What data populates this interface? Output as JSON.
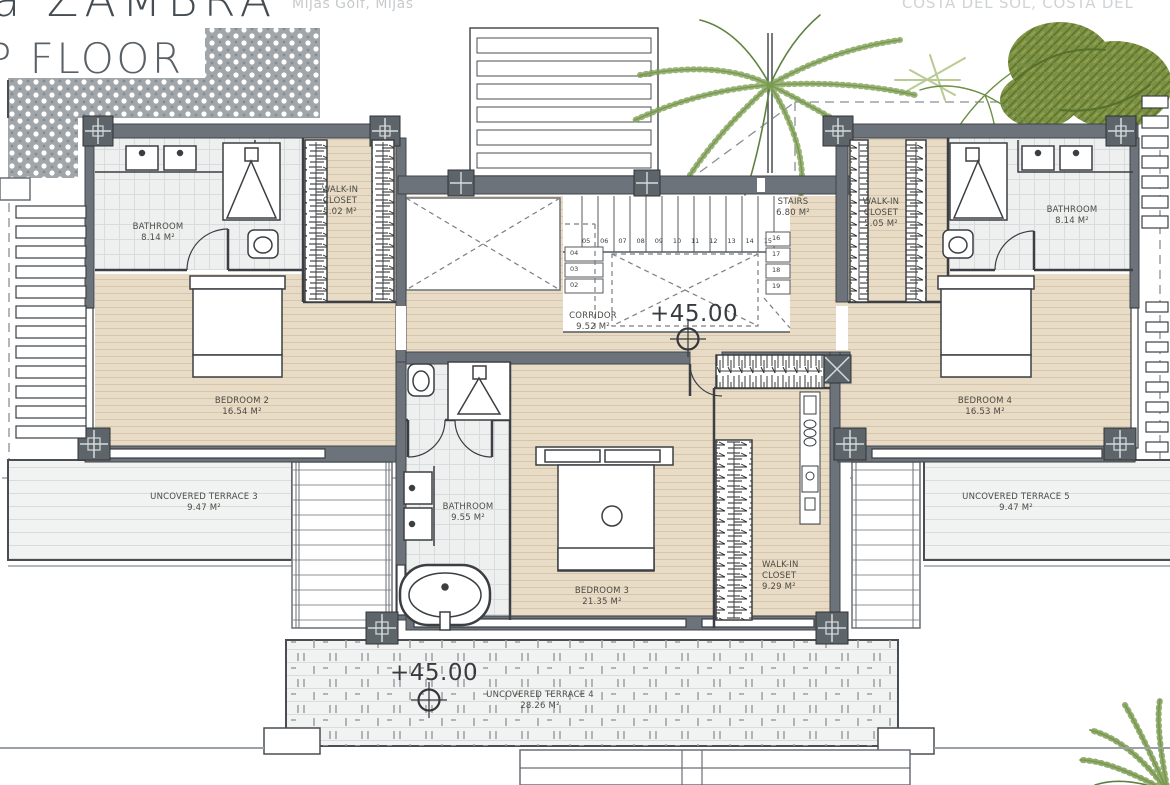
{
  "header": {
    "title_fragment": "a ZAMBRA",
    "subtitle": "Mijas Golf, Mijas",
    "location_line": "COSTA DEL SOL, COSTA DEL",
    "floor_label": "P FLOOR"
  },
  "rooms": {
    "bathroom2": {
      "name": "BATHROOM",
      "area": "8.14 M²"
    },
    "closet2": {
      "name": "WALK-IN CLOSET",
      "area": "5.02 M²"
    },
    "bedroom2": {
      "name": "BEDROOM 2",
      "area": "16.54 M²"
    },
    "stairs": {
      "name": "STAIRS",
      "area": "6.80 M²"
    },
    "corridor": {
      "name": "CORRIDOR",
      "area": "9.52 M²"
    },
    "closet4": {
      "name": "WALK-IN CLOSET",
      "area": "5.05 M²"
    },
    "bathroom4": {
      "name": "BATHROOM",
      "area": "8.14 M²"
    },
    "bedroom4": {
      "name": "BEDROOM 4",
      "area": "16.53 M²"
    },
    "bathroom3": {
      "name": "BATHROOM",
      "area": "9.55 M²"
    },
    "bedroom3": {
      "name": "BEDROOM 3",
      "area": "21.35 M²"
    },
    "closet3": {
      "name": "WALK-IN CLOSET",
      "area": "9.29 M²"
    },
    "terrace3": {
      "name": "UNCOVERED TERRACE 3",
      "area": "9.47 M²"
    },
    "terrace4": {
      "name": "UNCOVERED TERRACE 4",
      "area": "28.26 M²"
    },
    "terrace5": {
      "name": "UNCOVERED TERRACE 5",
      "area": "9.47 M²"
    }
  },
  "levels": {
    "corridor": "+45.00",
    "terrace": "+45.00"
  },
  "stairs_numbers": {
    "left": [
      "04",
      "03",
      "02"
    ],
    "top": [
      "05",
      "06",
      "07",
      "08",
      "09",
      "10",
      "11",
      "12",
      "13",
      "14",
      "15"
    ],
    "right": [
      "16",
      "17",
      "18",
      "19"
    ]
  },
  "colors": {
    "wall": "#6c737a",
    "wood_floor": "#e9dcc7",
    "tile_floor": "#eef0f0",
    "terrace_floor": "#f1f2f2",
    "greenery": "#7d9c52"
  }
}
